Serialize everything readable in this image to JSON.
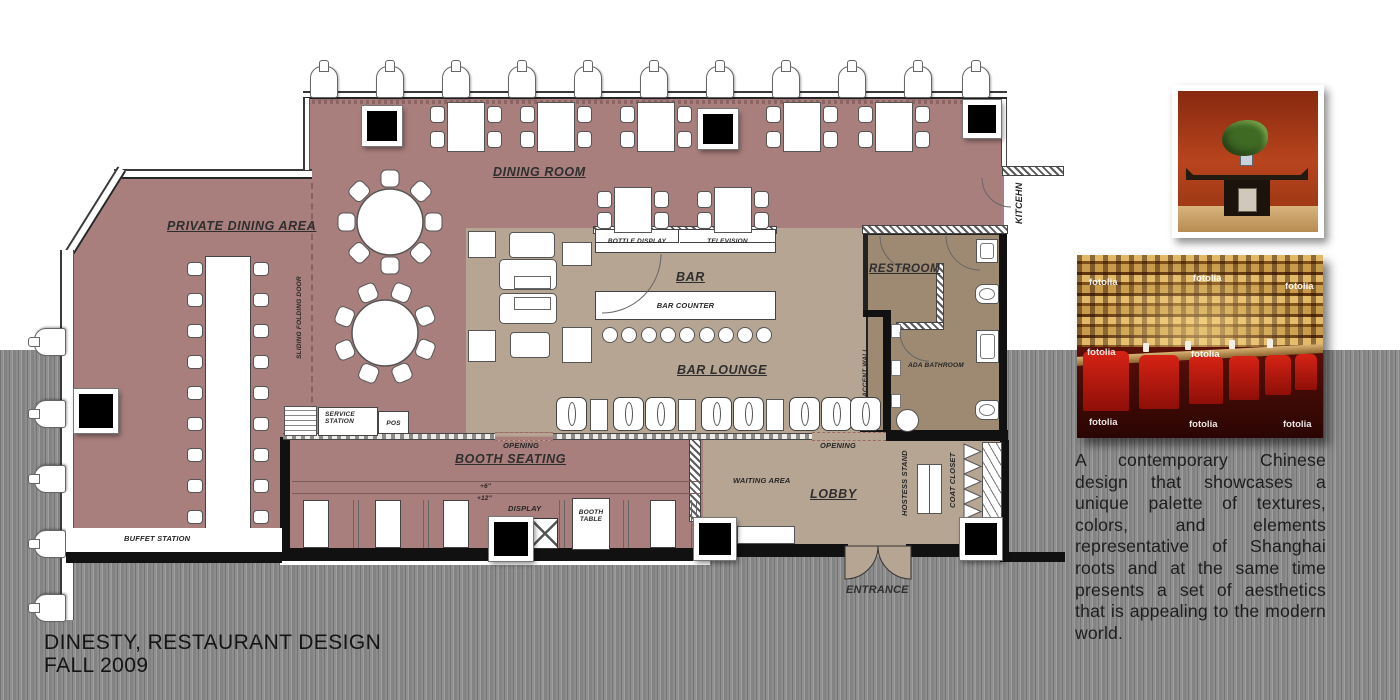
{
  "poster": {
    "title_line1": "DINESTY, RESTAURANT DESIGN",
    "title_line2": "FALL 2009",
    "description": "A contemporary Chinese design that showcases a unique palette of textures, colors, and elements representative of Shanghai roots and at the same time presents a set of aesthetics that is appealing to the modern world."
  },
  "plan": {
    "rooms": {
      "dining_room": "DINING ROOM",
      "private_dining_area": "PRIVATE DINING AREA",
      "bar": "BAR",
      "bar_lounge": "BAR LOUNGE",
      "booth_seating": "BOOTH SEATING",
      "lobby": "LOBBY",
      "restroom": "RESTROOM",
      "kitchen": "KITCEHN"
    },
    "features": {
      "bottle_display": "BOTTLE DISPLAY",
      "television": "TELEVISION",
      "bar_counter": "BAR COUNTER",
      "service_station": "SERVICE STATION",
      "pos": "POS",
      "sliding_folding_door": "SLIDING FOLDING DOOR",
      "accent_wall": "ACCENT WALL",
      "ada_bathroom": "ADA BATHROOM",
      "opening": "OPENING",
      "waiting_area": "WAITING AREA",
      "hostess_stand": "HOSTESS STAND",
      "coat_closet": "COAT CLOSET",
      "entrance": "ENTRANCE",
      "buffet_station": "BUFFET STATION",
      "booth_table": "BOOTH TABLE",
      "display": "DISPLAY",
      "elevation_6": "+6\"",
      "elevation_12": "+12\""
    }
  },
  "photos": {
    "stock_watermark": "fotolia"
  },
  "colors": {
    "dining_floor": "#a97f7d",
    "lounge_floor": "#b7a593",
    "restroom_floor": "#9e8a73",
    "background_band": "#8a8a8a",
    "photo_wall_red": "#b03d1b"
  }
}
